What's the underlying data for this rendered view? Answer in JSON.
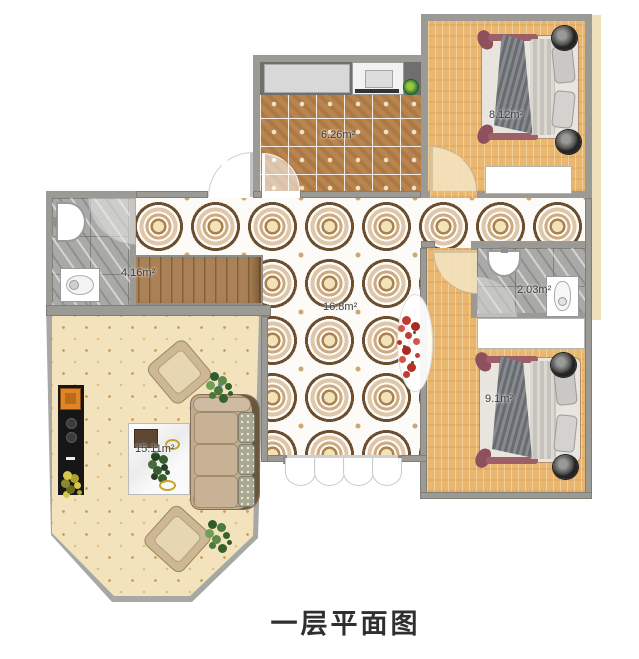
{
  "title": "一层平面图",
  "rooms": {
    "kitchen": {
      "area": "6.26m²"
    },
    "bedroom_top": {
      "area": "8.12m²"
    },
    "hall": {
      "area": "16.8m²"
    },
    "bathroom_left": {
      "area": "4.16m²"
    },
    "bathroom_right": {
      "area": "2.03m²"
    },
    "bedroom_bottom": {
      "area": "9.1m²"
    },
    "living_room": {
      "area": "15.11m²"
    }
  },
  "colors": {
    "wall": "#9c9a95",
    "wood_floor": "#eab771",
    "kitchen_tile": "#b9854e",
    "hall_tile_ring": "#6b4f30",
    "living_floor": "#f3e3bd",
    "marble": "#a9a9a7",
    "bed_frame": "#9d5f68",
    "sofa": "#c2aa8c",
    "flower_red": "#c23b30",
    "counter": "#6f6f6f"
  }
}
